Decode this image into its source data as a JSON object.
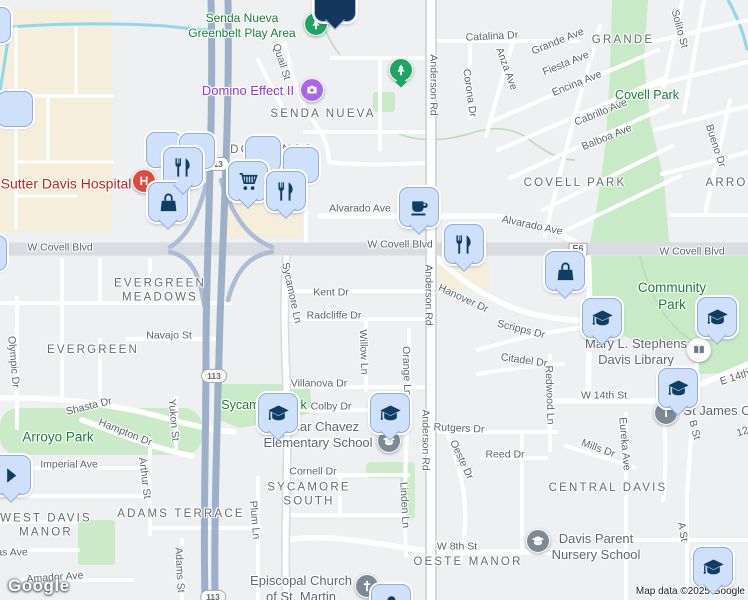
{
  "map": {
    "branding": {
      "logo": "Google",
      "attribution": "Map data ©2025 Google"
    },
    "colors": {
      "marker_fill": "#cfe0fb",
      "marker_border": "#8fadde",
      "marker_icon": "#0e3e62",
      "selected_pin": "#14375c",
      "park_fill": "#c9eac6",
      "commercial_fill": "#f4eedb",
      "freeway": "#9cb0c9",
      "water": "#8fd8ec",
      "park_label": "#188038",
      "hospital_red": "#dd4b3e",
      "attraction_purple": "#a967e6",
      "park_marker_green": "#1fa463",
      "school_gray": "#7d8a96"
    },
    "shields": [
      {
        "label": "113",
        "x": 216,
        "y": 164,
        "shape": "oval"
      },
      {
        "label": "113",
        "x": 214,
        "y": 376,
        "shape": "oval"
      },
      {
        "label": "113",
        "x": 213,
        "y": 597,
        "shape": "oval"
      },
      {
        "label": "E6",
        "x": 578,
        "y": 249,
        "shape": "rect"
      }
    ],
    "labels": {
      "streets": [
        {
          "t": "Catalina Dr",
          "x": 492,
          "y": 37,
          "r": -3
        },
        {
          "t": "Corona Dr",
          "x": 469,
          "y": 93,
          "r": 82
        },
        {
          "t": "Anderson Rd",
          "x": 433,
          "y": 85,
          "r": 90
        },
        {
          "t": "Anderson Rd",
          "x": 428,
          "y": 295,
          "r": 90
        },
        {
          "t": "Anderson Rd",
          "x": 425,
          "y": 440,
          "r": 90
        },
        {
          "t": "Quail St",
          "x": 281,
          "y": 62,
          "r": 72
        },
        {
          "t": "Grande Ave",
          "x": 558,
          "y": 42,
          "r": -22
        },
        {
          "t": "Fiesta Ave",
          "x": 566,
          "y": 64,
          "r": -22
        },
        {
          "t": "Encina Ave",
          "x": 577,
          "y": 84,
          "r": -22
        },
        {
          "t": "Anza Ave",
          "x": 506,
          "y": 69,
          "r": 70
        },
        {
          "t": "Solito St",
          "x": 679,
          "y": 29,
          "r": 75
        },
        {
          "t": "Cabrillo Ave",
          "x": 601,
          "y": 113,
          "r": -22
        },
        {
          "t": "Balboa Ave",
          "x": 607,
          "y": 138,
          "r": -22
        },
        {
          "t": "Bueno Dr",
          "x": 715,
          "y": 146,
          "r": 72
        },
        {
          "t": "Alvarado Ave",
          "x": 360,
          "y": 209,
          "r": 0
        },
        {
          "t": "Alvarado Ave",
          "x": 532,
          "y": 226,
          "r": 12
        },
        {
          "t": "W Covell Blvd",
          "x": 60,
          "y": 248,
          "r": 0
        },
        {
          "t": "W Covell Blvd",
          "x": 400,
          "y": 245,
          "r": 0
        },
        {
          "t": "W Covell Blvd",
          "x": 692,
          "y": 252,
          "r": 0
        },
        {
          "t": "Sycamore Ln",
          "x": 291,
          "y": 293,
          "r": 78
        },
        {
          "t": "Kent Dr",
          "x": 331,
          "y": 293,
          "r": 0
        },
        {
          "t": "Radcliffe Dr",
          "x": 334,
          "y": 316,
          "r": 0
        },
        {
          "t": "Willow Ln",
          "x": 363,
          "y": 352,
          "r": 88
        },
        {
          "t": "Orange Ln",
          "x": 406,
          "y": 371,
          "r": 88
        },
        {
          "t": "Hanover Dr",
          "x": 463,
          "y": 299,
          "r": 25
        },
        {
          "t": "Villanova Dr",
          "x": 319,
          "y": 384,
          "r": 0
        },
        {
          "t": "Colby Dr",
          "x": 331,
          "y": 407,
          "r": 0
        },
        {
          "t": "Navajo St",
          "x": 169,
          "y": 336,
          "r": 0
        },
        {
          "t": "Olympic Dr",
          "x": 13,
          "y": 362,
          "r": 85
        },
        {
          "t": "Shasta Dr",
          "x": 89,
          "y": 407,
          "r": -14
        },
        {
          "t": "Hampton Dr",
          "x": 125,
          "y": 433,
          "r": 22
        },
        {
          "t": "Yukon St",
          "x": 173,
          "y": 420,
          "r": 85
        },
        {
          "t": "Arthur St",
          "x": 144,
          "y": 478,
          "r": 83
        },
        {
          "t": "Imperial Ave",
          "x": 69,
          "y": 465,
          "r": 0
        },
        {
          "t": "Amador Ave",
          "x": 55,
          "y": 578,
          "r": -4
        },
        {
          "t": "Adams St",
          "x": 179,
          "y": 570,
          "r": 87
        },
        {
          "t": "Plum Ln",
          "x": 254,
          "y": 520,
          "r": 85
        },
        {
          "t": "Linden Ln",
          "x": 404,
          "y": 505,
          "r": 87
        },
        {
          "t": "Cornell Dr",
          "x": 313,
          "y": 472,
          "r": 0
        },
        {
          "t": "Scripps Dr",
          "x": 521,
          "y": 330,
          "r": 14
        },
        {
          "t": "Citadel Dr",
          "x": 524,
          "y": 361,
          "r": 8
        },
        {
          "t": "Redwood Ln",
          "x": 549,
          "y": 395,
          "r": 88
        },
        {
          "t": "Rutgers Dr",
          "x": 459,
          "y": 429,
          "r": 3
        },
        {
          "t": "Oeste Dr",
          "x": 461,
          "y": 460,
          "r": 65
        },
        {
          "t": "Reed Dr",
          "x": 505,
          "y": 455,
          "r": 0
        },
        {
          "t": "Mills Dr",
          "x": 598,
          "y": 449,
          "r": 20
        },
        {
          "t": "Eureka Ave",
          "x": 624,
          "y": 444,
          "r": 85
        },
        {
          "t": "W 14th St",
          "x": 604,
          "y": 396,
          "r": 0
        },
        {
          "t": "E 14th St",
          "x": 741,
          "y": 376,
          "r": -18
        },
        {
          "t": "12th St",
          "x": 753,
          "y": 429,
          "r": -18
        },
        {
          "t": "W 8th St",
          "x": 457,
          "y": 547,
          "r": 0
        },
        {
          "t": "B St",
          "x": 694,
          "y": 430,
          "r": 75
        },
        {
          "t": "A St",
          "x": 682,
          "y": 532,
          "r": 80
        },
        {
          "t": "as Ave",
          "x": 12,
          "y": 553,
          "r": 0
        }
      ],
      "areas": [
        {
          "t": "SENDA NUEVA",
          "x": 323,
          "y": 114
        },
        {
          "t": "DOS PINOS",
          "x": 272,
          "y": 150
        },
        {
          "t": "GRANDE",
          "x": 623,
          "y": 40
        },
        {
          "t": "COVELL PARK",
          "x": 575,
          "y": 183
        },
        {
          "t": "ARROW",
          "x": 733,
          "y": 183
        },
        {
          "t": "EVERGREEN\nMEADOWS",
          "x": 160,
          "y": 291
        },
        {
          "t": "EVERGREEN",
          "x": 93,
          "y": 350
        },
        {
          "t": "CENTRAL DAVIS",
          "x": 608,
          "y": 488
        },
        {
          "t": "SYCAMORE\nSOUTH",
          "x": 309,
          "y": 495
        },
        {
          "t": "ADAMS TERRACE",
          "x": 181,
          "y": 514
        },
        {
          "t": "WEST DAVIS\nMANOR",
          "x": 46,
          "y": 526
        },
        {
          "t": "OESTE MANOR",
          "x": 468,
          "y": 562
        }
      ],
      "parks": [
        {
          "t": "Senda Nueva\nGreenbelt Play Area",
          "x": 242,
          "y": 26,
          "fs": 12
        },
        {
          "t": "Covell Park",
          "x": 647,
          "y": 96
        },
        {
          "t": "Community\nPark",
          "x": 672,
          "y": 297,
          "fs": 13.5
        },
        {
          "t": "Arroyo Park",
          "x": 58,
          "y": 438,
          "fs": 13.5
        },
        {
          "t": "Sycamore Park",
          "x": 264,
          "y": 406
        }
      ],
      "pois": [
        {
          "t": "Sutter Davis Hospital",
          "x": 66,
          "y": 184,
          "c": "red"
        },
        {
          "t": "Domino Effect II",
          "x": 248,
          "y": 91,
          "c": "purple"
        },
        {
          "t": "Mary L. Stephens\nDavis Library",
          "x": 636,
          "y": 352,
          "c": "gray",
          "fs": 13
        },
        {
          "t": "Cesar Chavez\nElementary School",
          "x": 318,
          "y": 435,
          "c": "gray",
          "fs": 13
        },
        {
          "t": "Episcopal Church\nof St. Martin",
          "x": 301,
          "y": 589,
          "c": "gray",
          "fs": 13
        },
        {
          "t": "Davis Parent\nNursery School",
          "x": 596,
          "y": 547,
          "c": "gray",
          "fs": 13
        },
        {
          "t": "St James C",
          "x": 717,
          "y": 411,
          "c": "gray",
          "fs": 13
        }
      ]
    },
    "poi_circles": [
      {
        "glyph": "H",
        "x": 144,
        "y": 181,
        "bg": "#dd4b3e",
        "name": "hospital-icon"
      },
      {
        "icon": "camera",
        "x": 312,
        "y": 90,
        "bg": "#a967e6",
        "name": "camera-icon"
      },
      {
        "icon": "tree",
        "x": 316,
        "y": 24,
        "bg": "#1fa463",
        "name": "park-tree-icon"
      },
      {
        "icon": "tree",
        "x": 401,
        "y": 70,
        "bg": "#1fa463",
        "tail": true,
        "name": "park-tree-icon"
      },
      {
        "icon": "book",
        "x": 699,
        "y": 350,
        "bg": "#ffffff",
        "fg": "#6e7b86",
        "name": "library-book-icon"
      },
      {
        "icon": "grad",
        "x": 389,
        "y": 441,
        "bg": "#7d8a96",
        "name": "school-icon"
      },
      {
        "icon": "grad",
        "x": 538,
        "y": 541,
        "bg": "#7d8a96",
        "name": "school-icon"
      },
      {
        "icon": "cross",
        "x": 367,
        "y": 586,
        "bg": "#7d8a96",
        "name": "church-cross-icon"
      },
      {
        "glyph": "T",
        "x": 666,
        "y": 413,
        "bg": "#7d8a96",
        "name": "poi-letter-icon"
      }
    ],
    "markers": [
      {
        "icon": "plain",
        "x": -8,
        "y": 24,
        "variant": "back",
        "tail": false
      },
      {
        "icon": "plain",
        "x": 14,
        "y": 108,
        "variant": "back",
        "tail": false
      },
      {
        "icon": "plain",
        "x": -12,
        "y": 252,
        "variant": "back",
        "tail": false
      },
      {
        "icon": "plain",
        "x": 163,
        "y": 149,
        "variant": "back",
        "tail": false
      },
      {
        "icon": "plain",
        "x": 196,
        "y": 150,
        "variant": "back",
        "tail": false
      },
      {
        "icon": "fork-knife",
        "x": 182,
        "y": 166,
        "variant": "front",
        "tail": true
      },
      {
        "icon": "shopping-bag",
        "x": 167,
        "y": 201,
        "variant": "front",
        "tail": true
      },
      {
        "icon": "plain",
        "x": 262,
        "y": 153,
        "variant": "back",
        "tail": false
      },
      {
        "icon": "plain",
        "x": 300,
        "y": 164,
        "variant": "back",
        "tail": false
      },
      {
        "icon": "shopping-cart",
        "x": 247,
        "y": 180,
        "variant": "front",
        "tail": true
      },
      {
        "icon": "fork-knife",
        "x": 285,
        "y": 190,
        "variant": "front",
        "tail": true
      },
      {
        "icon": "coffee-cup",
        "x": 418,
        "y": 206,
        "variant": "front",
        "tail": true
      },
      {
        "icon": "fork-knife",
        "x": 463,
        "y": 243,
        "variant": "front",
        "tail": true
      },
      {
        "icon": "shopping-bag",
        "x": 564,
        "y": 270,
        "variant": "front",
        "tail": true
      },
      {
        "icon": "graduation-cap",
        "x": 601,
        "y": 317,
        "variant": "front",
        "tail": true
      },
      {
        "icon": "graduation-cap",
        "x": 716,
        "y": 316,
        "variant": "front",
        "tail": true
      },
      {
        "icon": "graduation-cap",
        "x": 677,
        "y": 387,
        "variant": "front",
        "tail": true
      },
      {
        "icon": "graduation-cap",
        "x": 277,
        "y": 412,
        "variant": "front",
        "tail": true
      },
      {
        "icon": "graduation-cap",
        "x": 389,
        "y": 412,
        "variant": "front",
        "tail": true
      },
      {
        "icon": "graduation-cap",
        "x": 712,
        "y": 566,
        "variant": "front",
        "tail": true
      },
      {
        "icon": "person",
        "x": 390,
        "y": 603,
        "variant": "front",
        "tail": false
      },
      {
        "icon": "arrow-right",
        "x": 10,
        "y": 474,
        "variant": "front",
        "tail": true
      },
      {
        "icon": "selected",
        "x": 334,
        "y": 0,
        "variant": "selected",
        "tail": true
      }
    ]
  }
}
